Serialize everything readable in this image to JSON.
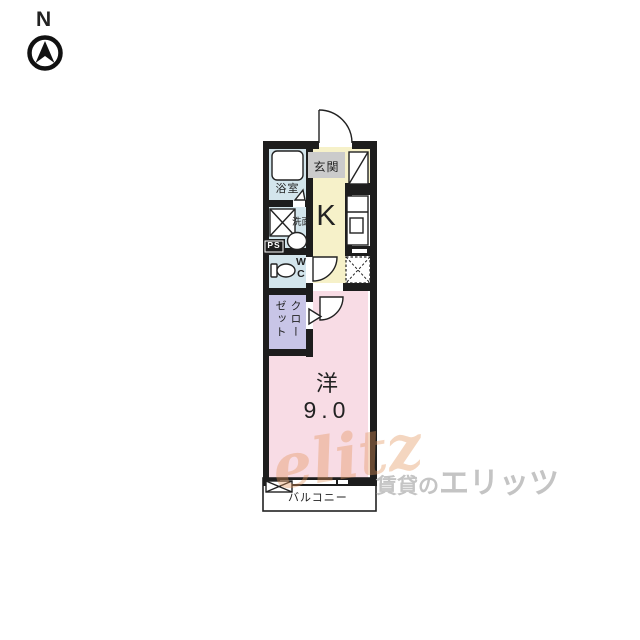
{
  "compass": {
    "label": "N"
  },
  "rooms": {
    "entrance": {
      "label": "玄関"
    },
    "bathroom": {
      "label": "浴室"
    },
    "washroom": {
      "label": "洗面"
    },
    "pipe_space": {
      "label": "PS"
    },
    "wc": {
      "label": "WC",
      "line1": "W",
      "line2": "C"
    },
    "kitchen": {
      "label": "K"
    },
    "closet": {
      "label": "クローゼット",
      "col_right": "クロー",
      "col_left": "ゼット"
    },
    "western_room": {
      "label": "洋",
      "size": "9.0"
    },
    "balcony": {
      "label": "バルコニー"
    }
  },
  "colors": {
    "wall": "#1d1d1d",
    "wet_area": "#d3e5ec",
    "kitchen_floor": "#f6f1c9",
    "closet_floor": "#c8c5e7",
    "room_floor": "#f8dce5",
    "entrance_sign_bg": "#cbcbcb",
    "watermark_gray": "#c4c4c4",
    "watermark_orange": "#e79a5f"
  },
  "watermark": {
    "logo": "elitz",
    "text_small": "賃貸の",
    "text_large": "エリッツ"
  }
}
